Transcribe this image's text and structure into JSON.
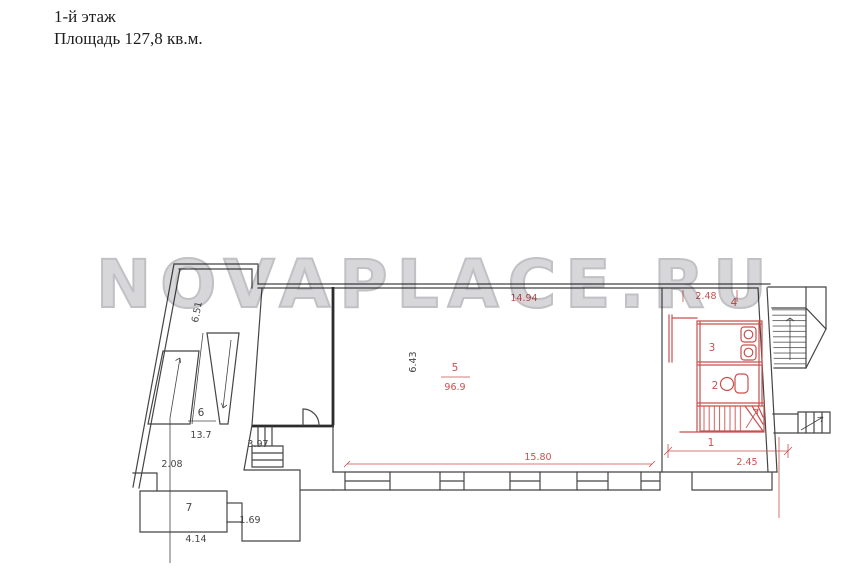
{
  "header": {
    "line1": "1-й этаж",
    "line2": "Площадь 127,8 кв.м."
  },
  "watermark": {
    "text": "NOVAPLACE.RU"
  },
  "rooms": {
    "r1": "1",
    "r2": "2",
    "r3": "3",
    "r4": "4",
    "r5": "5",
    "r5_area": "96.9",
    "r6": "6",
    "r6_area": "13.7",
    "r7": "7"
  },
  "dims": {
    "d651": "6.51",
    "d643": "6.43",
    "d1494": "14.94",
    "d248": "2.48",
    "d397": "3.97",
    "d208": "2.08",
    "d1580": "15.80",
    "d245": "2.45",
    "d169": "1.69",
    "d414": "4.14"
  },
  "colors": {
    "ink": "#454545",
    "red": "#c9504e",
    "watermark_fill": "#d4d4d8",
    "watermark_stroke": "#bcbcc1"
  }
}
